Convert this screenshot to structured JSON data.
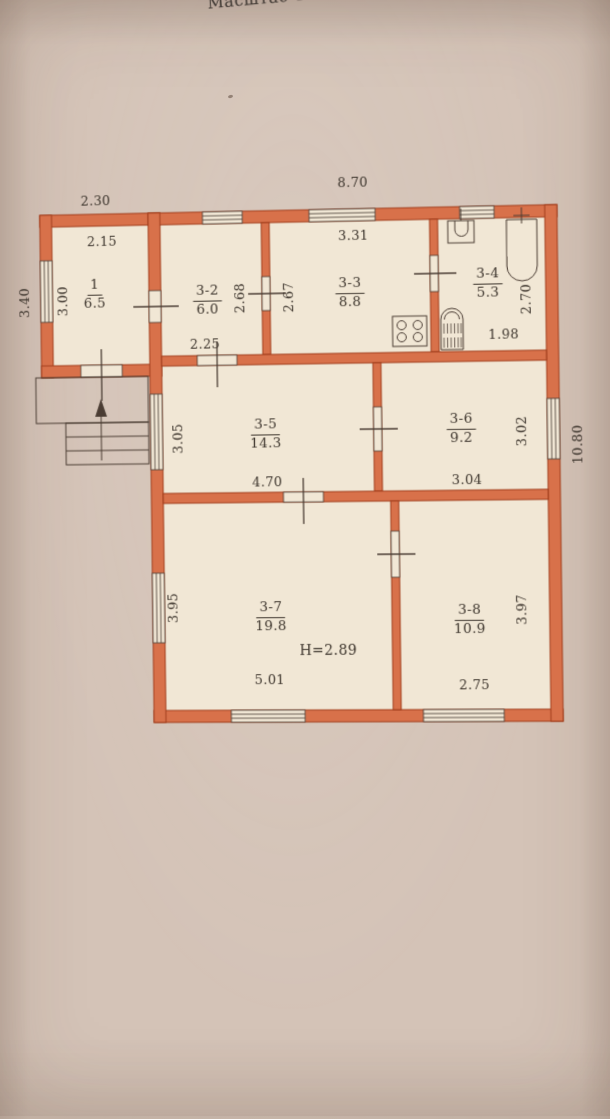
{
  "photo": {
    "scale_title": "Масштаб 1:100"
  },
  "plan": {
    "outer": {
      "annex_width": "2.30",
      "main_width": "8.70",
      "annex_height": "3.40",
      "main_height": "10.80"
    },
    "height_note": "H=2.89",
    "rooms": [
      {
        "num": "1",
        "area": "6.5",
        "w": "2.15",
        "h": "3.00"
      },
      {
        "num": "3-2",
        "area": "6.0",
        "w": "2.25",
        "h": "2.68"
      },
      {
        "num": "3-3",
        "area": "8.8",
        "w": "3.31",
        "h": "2.67"
      },
      {
        "num": "3-4",
        "area": "5.3",
        "w": "1.98",
        "h": "2.70"
      },
      {
        "num": "3-5",
        "area": "14.3",
        "w": "4.70",
        "h": "3.05"
      },
      {
        "num": "3-6",
        "area": "9.2",
        "w": "3.04",
        "h": "3.02"
      },
      {
        "num": "3-7",
        "area": "19.8",
        "w": "5.01",
        "h": "3.95"
      },
      {
        "num": "3-8",
        "area": "10.9",
        "w": "2.75",
        "h": "3.97"
      }
    ],
    "fixtures": [
      {
        "name": "bathtub"
      },
      {
        "name": "sink"
      },
      {
        "name": "gas-stove"
      },
      {
        "name": "water-heater"
      },
      {
        "name": "entry-stairs"
      }
    ],
    "colors": {
      "wall_fill": "#d8714a",
      "wall_outline": "#a13f1d",
      "room_fill": "#f1e7d5",
      "paper": "#d4c3b7",
      "ink": "#4a3c33",
      "text": "#3d352d"
    }
  }
}
